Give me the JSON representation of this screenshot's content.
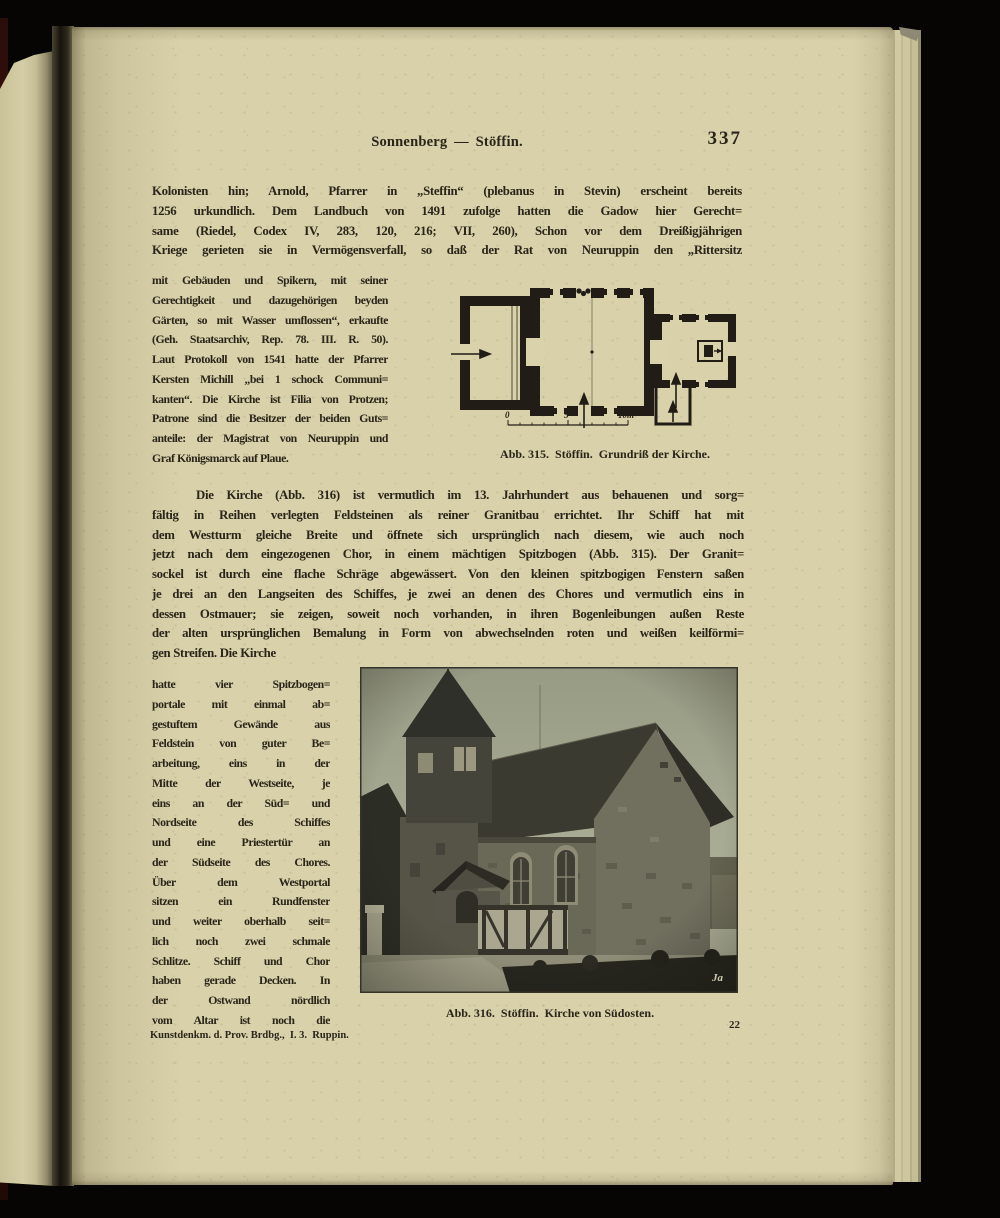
{
  "colors": {
    "paper": "#d8d1a9",
    "ink": "#2a251a",
    "plan_ink": "#211d16",
    "photo_sky": "#a9ac94",
    "photo_dark": "#33322a",
    "cover_maroon": "#4a1711",
    "scan_background": "#070503"
  },
  "header": {
    "title": "Sonnenberg — Stöffin.",
    "page_number": "337"
  },
  "paragraph1": {
    "lines": [
      "Kolonisten hin; Arnold, Pfarrer in „Steffin“ (plebanus in Stevin) erscheint bereits",
      "1256 urkundlich.  Dem Landbuch von 1491 zufolge hatten die Gadow hier Gerecht=",
      "same (Riedel, Codex IV, 283, 120, 216; VII, 260),  Schon vor dem Dreißigjährigen",
      "Kriege gerieten sie in Vermögensverfall, so daß der Rat von Neuruppin den „Rittersitz"
    ]
  },
  "column1": {
    "lines": [
      "mit Gebäuden und Spikern, mit seiner",
      "Gerechtigkeit und dazugehörigen beyden",
      "Gärten, so mit Wasser umflossen“, erkaufte",
      "(Geh. Staatsarchiv, Rep. 78. III. R. 50).",
      "Laut Protokoll von 1541 hatte der Pfarrer",
      "Kersten Michill „bei 1 schock Communi=",
      "kanten“.  Die Kirche ist Filia von Protzen;",
      "Patrone sind die Besitzer der  beiden Guts=",
      "anteile: der Magistrat von Neuruppin und",
      "Graf Königsmarck auf Plaue."
    ]
  },
  "figure_plan": {
    "caption": "Abb. 315.  Stöffin.  Grundriß der Kirche.",
    "scale_0": "0",
    "scale_5": "5",
    "scale_10": "10m"
  },
  "paragraph2": {
    "lines": [
      "Die Kirche (Abb. 316) ist vermutlich im 13. Jahrhundert aus behauenen und sorg=",
      "fältig in Reihen verlegten Feldsteinen als reiner Granitbau errichtet.  Ihr Schiff hat mit",
      "dem Westturm gleiche Breite und öffnete sich ursprünglich nach diesem, wie auch noch",
      "jetzt nach dem eingezogenen Chor, in einem mächtigen Spitzbogen (Abb. 315).  Der Granit=",
      "sockel ist durch eine flache Schräge abgewässert. Von den kleinen spitzbogigen Fenstern saßen",
      "je drei an den Langseiten des Schiffes, je zwei an denen des Chores und vermutlich eins in",
      "dessen Ostmauer; sie zeigen, soweit noch vorhanden, in ihren Bogenleibungen außen Reste",
      "der alten ursprünglichen Bemalung in Form von abwechselnden roten und weißen keilförmi=",
      "gen Streifen.  Die Kirche"
    ]
  },
  "column2": {
    "lines": [
      "hatte vier Spitzbogen=",
      "portale mit einmal ab=",
      "gestuftem Gewände aus",
      "Feldstein von guter Be=",
      "arbeitung, eins in der",
      "Mitte der Westseite, je",
      "eins an der Süd= und",
      "Nordseite des Schiffes",
      "und eine Priestertür an",
      "der Südseite des Chores.",
      "Über dem Westportal",
      "sitzen ein Rundfenster",
      "und weiter oberhalb seit=",
      "lich noch zwei schmale",
      "Schlitze. Schiff und Chor",
      "haben gerade Decken. In",
      "der Ostwand nördlich",
      "vom Altar ist noch die"
    ]
  },
  "figure_photo": {
    "caption": "Abb. 316.  Stöffin.  Kirche von Südosten.",
    "signature": "Ja"
  },
  "footer": {
    "imprint": "Kunstdenkm. d. Prov. Brdbg.,  I. 3.  Ruppin.",
    "sheet_number": "22"
  }
}
